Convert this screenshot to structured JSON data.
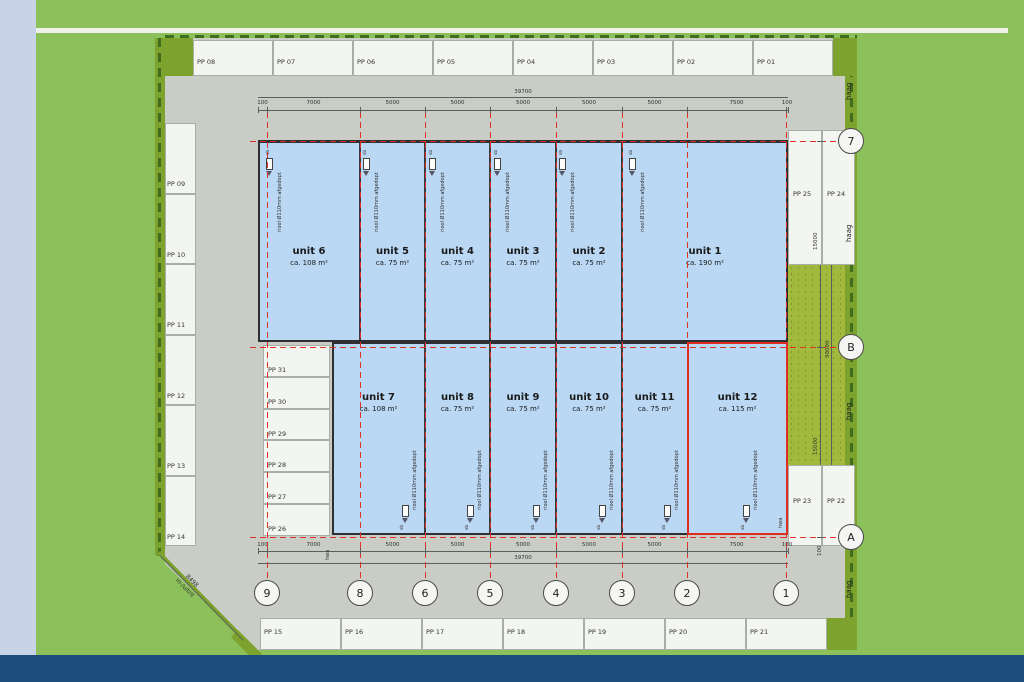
{
  "annotations": {
    "hedge": "haag",
    "sewer_label": "riool Ø110mm afgedopt",
    "sewer_tag": "sb",
    "rain_drain": "hwa"
  },
  "parking": {
    "top_row": [
      "PP 08",
      "PP 07",
      "PP 06",
      "PP 05",
      "PP 04",
      "PP 03",
      "PP 02",
      "PP 01"
    ],
    "left_column": [
      "PP 09",
      "PP 10",
      "PP 11",
      "PP 12",
      "PP 13",
      "PP 14"
    ],
    "inner_column": [
      "PP 31",
      "PP 30",
      "PP 29",
      "PP 28",
      "PP 27",
      "PP 26"
    ],
    "bottom_row": [
      "PP 15",
      "PP 16",
      "PP 17",
      "PP 18",
      "PP 19",
      "PP 20",
      "PP 21"
    ],
    "right_top": [
      "PP 25",
      "PP 24"
    ],
    "right_bottom": [
      "PP 23",
      "PP 22"
    ]
  },
  "units": {
    "top_row": [
      {
        "name": "unit 6",
        "area": "ca. 108 m²"
      },
      {
        "name": "unit 5",
        "area": "ca. 75 m²"
      },
      {
        "name": "unit 4",
        "area": "ca. 75 m²"
      },
      {
        "name": "unit 3",
        "area": "ca. 75 m²"
      },
      {
        "name": "unit 2",
        "area": "ca. 75 m²"
      },
      {
        "name": "unit 1",
        "area": "ca. 190 m²"
      }
    ],
    "bottom_row": [
      {
        "name": "unit 7",
        "area": "ca. 108 m²"
      },
      {
        "name": "unit 8",
        "area": "ca. 75 m²"
      },
      {
        "name": "unit 9",
        "area": "ca. 75 m²"
      },
      {
        "name": "unit 10",
        "area": "ca. 75 m²"
      },
      {
        "name": "unit 11",
        "area": "ca. 75 m²"
      },
      {
        "name": "unit 12",
        "area": "ca. 115 m²"
      }
    ]
  },
  "grid_axes": {
    "bottom": [
      "9",
      "8",
      "6",
      "5",
      "4",
      "3",
      "2",
      "1"
    ],
    "right": [
      "7",
      "B",
      "A"
    ]
  },
  "dimensions": {
    "top_total": "39700",
    "top_segments": [
      "100",
      "7000",
      "5000",
      "5000",
      "5000",
      "5000",
      "5000",
      "7500",
      "100"
    ],
    "bottom_total": "39700",
    "bottom_segments": [
      "100",
      "7000",
      "5000",
      "5000",
      "5000",
      "5000",
      "5000",
      "7500",
      "100"
    ],
    "right_segments": [
      "15000",
      "15000"
    ],
    "right_total": "30000",
    "right_end": "100",
    "driveway_length": "8498",
    "driveway_label": "in-/uitrit"
  },
  "colors": {
    "site_green": "#8cc05a",
    "hedge_olive": "#7ea22e",
    "hedge_speckled": "#a3b93e",
    "paving_gray": "#c9cdc6",
    "building_blue": "#bad7f3",
    "axis_red": "#e03126",
    "footer_navy": "#1d4d7c",
    "margin_lavender": "#c9d3e8"
  }
}
